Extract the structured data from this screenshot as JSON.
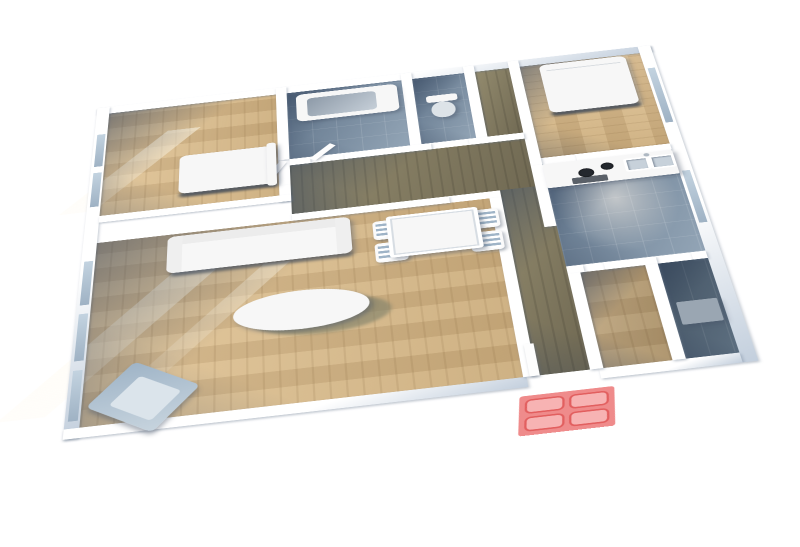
{
  "meta": {
    "description": "3D isometric rendering of an apartment floor plan viewed from above, on a plain white background; no visible text"
  },
  "colors": {
    "wall": "#ffffff",
    "wall-shade": "#c3cfdd",
    "wood": "#e2c79c",
    "wood-deep": "#c9ab7c",
    "darkwood": "#938b6e",
    "darkwood-deep": "#6f6852",
    "tile": "#5f7389",
    "tile-light": "#93a5b6",
    "kitchen-center": "#c2c6c9",
    "furn": "#f7f7f7",
    "steel": "#9fb4c7",
    "appliance": "#9aa6b2",
    "glass": "#c3d3e0",
    "mat-base": "#ef8b8b",
    "mat-cell": "#f7b3b3",
    "mat-border": "#e25f5f"
  },
  "rooms": [
    {
      "id": "bedroom-1",
      "position": "top-left",
      "floor": "wood",
      "contents": [
        "single-bed",
        "window-wall"
      ]
    },
    {
      "id": "bathroom",
      "position": "top-middle",
      "floor": "blue-gray-tile",
      "contents": [
        "bathtub"
      ]
    },
    {
      "id": "wc",
      "position": "top-middle-right",
      "floor": "blue-gray-tile",
      "contents": [
        "toilet"
      ]
    },
    {
      "id": "bedroom-2",
      "position": "top-right",
      "floor": "wood",
      "contents": [
        "double-bed",
        "window-wall"
      ]
    },
    {
      "id": "hallway",
      "position": "center",
      "floor": "dark-wood",
      "contents": []
    },
    {
      "id": "kitchen",
      "position": "middle-right",
      "floor": "tile-with-light-center",
      "contents": [
        "counter-with-stove-and-double-sink"
      ]
    },
    {
      "id": "living-room",
      "position": "bottom-left",
      "floor": "wood",
      "contents": [
        "sofa",
        "coffee-table",
        "armchair",
        "dining-table-with-four-chairs",
        "french-windows"
      ]
    },
    {
      "id": "storage-room",
      "position": "bottom-right-left",
      "floor": "wood",
      "contents": []
    },
    {
      "id": "laundry-room",
      "position": "bottom-right",
      "floor": "dark-tile",
      "contents": [
        "washing-machine"
      ]
    }
  ],
  "entrance": {
    "item": "red-doormat",
    "pattern": "2x2 rounded cells",
    "location": "outside bottom wall, center"
  }
}
